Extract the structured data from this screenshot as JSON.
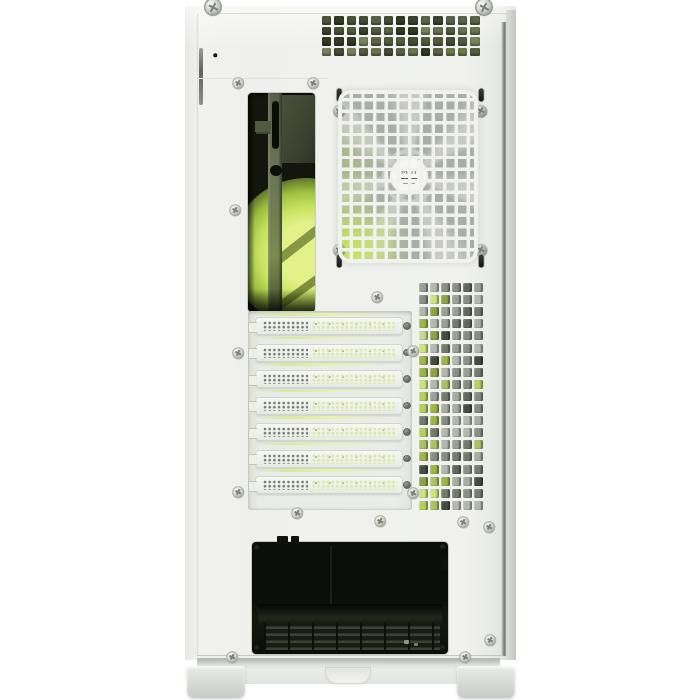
{
  "scene": {
    "subject": "Rear view of a white mid-tower PC case with green RGB lighting glowing through the vents",
    "background": "#ffffff"
  },
  "branding": {
    "fan_hub_label": "MSI"
  },
  "colors": {
    "case_body": "#f0f1ee",
    "edge_dark": "#777b71",
    "glow_green": "#c8e25e",
    "psu_dark": "#0b0d08",
    "fan_blade_gray": "#b4b9b0",
    "grid_white": "#f1f2ee"
  },
  "top_grille": {
    "rows": 4,
    "cols": 13,
    "palette": [
      "#4d5339",
      "#5c634a",
      "#3d422e",
      "#6a7350",
      "#545b3f",
      "#464c34",
      "#79825a",
      "#343925",
      "#6c7a46"
    ]
  },
  "side_vent": {
    "rows": 19,
    "cols": 6,
    "green_palette": [
      "#b9cf5d",
      "#cfe381",
      "#9cb648",
      "#aec163",
      "#c6d893",
      "#8fa149"
    ],
    "gray_palette": [
      "#9aa094",
      "#8b9085",
      "#757a6f",
      "#a8ada2",
      "#62675d",
      "#474c42",
      "#b4b8ae",
      "#888d82"
    ],
    "green_chance_by_col": [
      0.8,
      0.5,
      0.18,
      0.06,
      0.05,
      0.12
    ]
  },
  "pci_slots": {
    "count": 7
  },
  "fixings": {
    "thumb_screws": [
      [
        213,
        7
      ],
      [
        484,
        7
      ]
    ],
    "panel_screws": [
      [
        238,
        83
      ],
      [
        313,
        83
      ],
      [
        235,
        210
      ],
      [
        377,
        297
      ],
      [
        238,
        353
      ],
      [
        413,
        351
      ],
      [
        238,
        492
      ],
      [
        413,
        493
      ],
      [
        297,
        513
      ],
      [
        380,
        521
      ],
      [
        463,
        522
      ],
      [
        489,
        527
      ],
      [
        232,
        657
      ],
      [
        465,
        657
      ],
      [
        490,
        640
      ]
    ],
    "fan_screws": [
      [
        339,
        111
      ],
      [
        481,
        111
      ],
      [
        339,
        250
      ],
      [
        481,
        250
      ]
    ],
    "keyholes": [
      [
        339,
        95
      ],
      [
        481,
        95
      ],
      [
        339,
        261
      ],
      [
        481,
        261
      ]
    ],
    "holes": [
      [
        215,
        55,
        3.5
      ],
      [
        257,
        548,
        6
      ],
      [
        443,
        547,
        6
      ],
      [
        257,
        648,
        6
      ],
      [
        443,
        648,
        6
      ]
    ],
    "psu_notches": [
      [
        277,
        536,
        11,
        8
      ],
      [
        291,
        536,
        8,
        8
      ],
      [
        441,
        559,
        7,
        11
      ]
    ]
  }
}
